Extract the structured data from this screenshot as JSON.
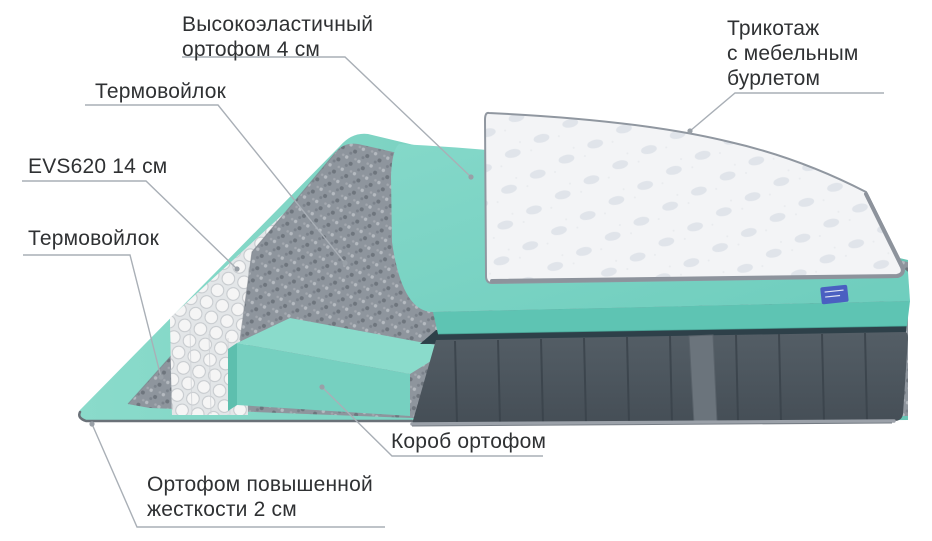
{
  "diagram": {
    "kind": "mattress-layers-cutaway",
    "layer_count": 7
  },
  "labels": {
    "top_foam": {
      "line1": "Высокоэластичный",
      "line2": "ортофом 4 см"
    },
    "knit": {
      "line1": "Трикотаж",
      "line2": "с мебельным",
      "line3": "бурлетом"
    },
    "thermofelt_upper": {
      "text": "Термовойлок"
    },
    "springs": {
      "text": "EVS620 14 см"
    },
    "thermofelt_lower": {
      "text": "Термовойлок"
    },
    "box": {
      "text": "Короб ортофом"
    },
    "base_foam": {
      "line1": "Ортофом повышенной",
      "line2": "жесткости 2 см"
    }
  },
  "colors": {
    "background": "#ffffff",
    "label_text": "#2f3133",
    "leader_line": "#a9afb6",
    "foam_teal": "#79d2c3",
    "foam_teal_side": "#5ec4b3",
    "felt_gray": "#8e959d",
    "cover_white": "#f4f5f7",
    "cover_rim": "#9097a0",
    "side_velour": "#4d575f",
    "side_seam": "#3a434b",
    "side_band": "#2e4049",
    "handle_gray": "#6b747c",
    "piping_gray": "#9ba1a9",
    "spring_white": "#f4f4f4",
    "tag_blue": "#4a5fc1"
  }
}
